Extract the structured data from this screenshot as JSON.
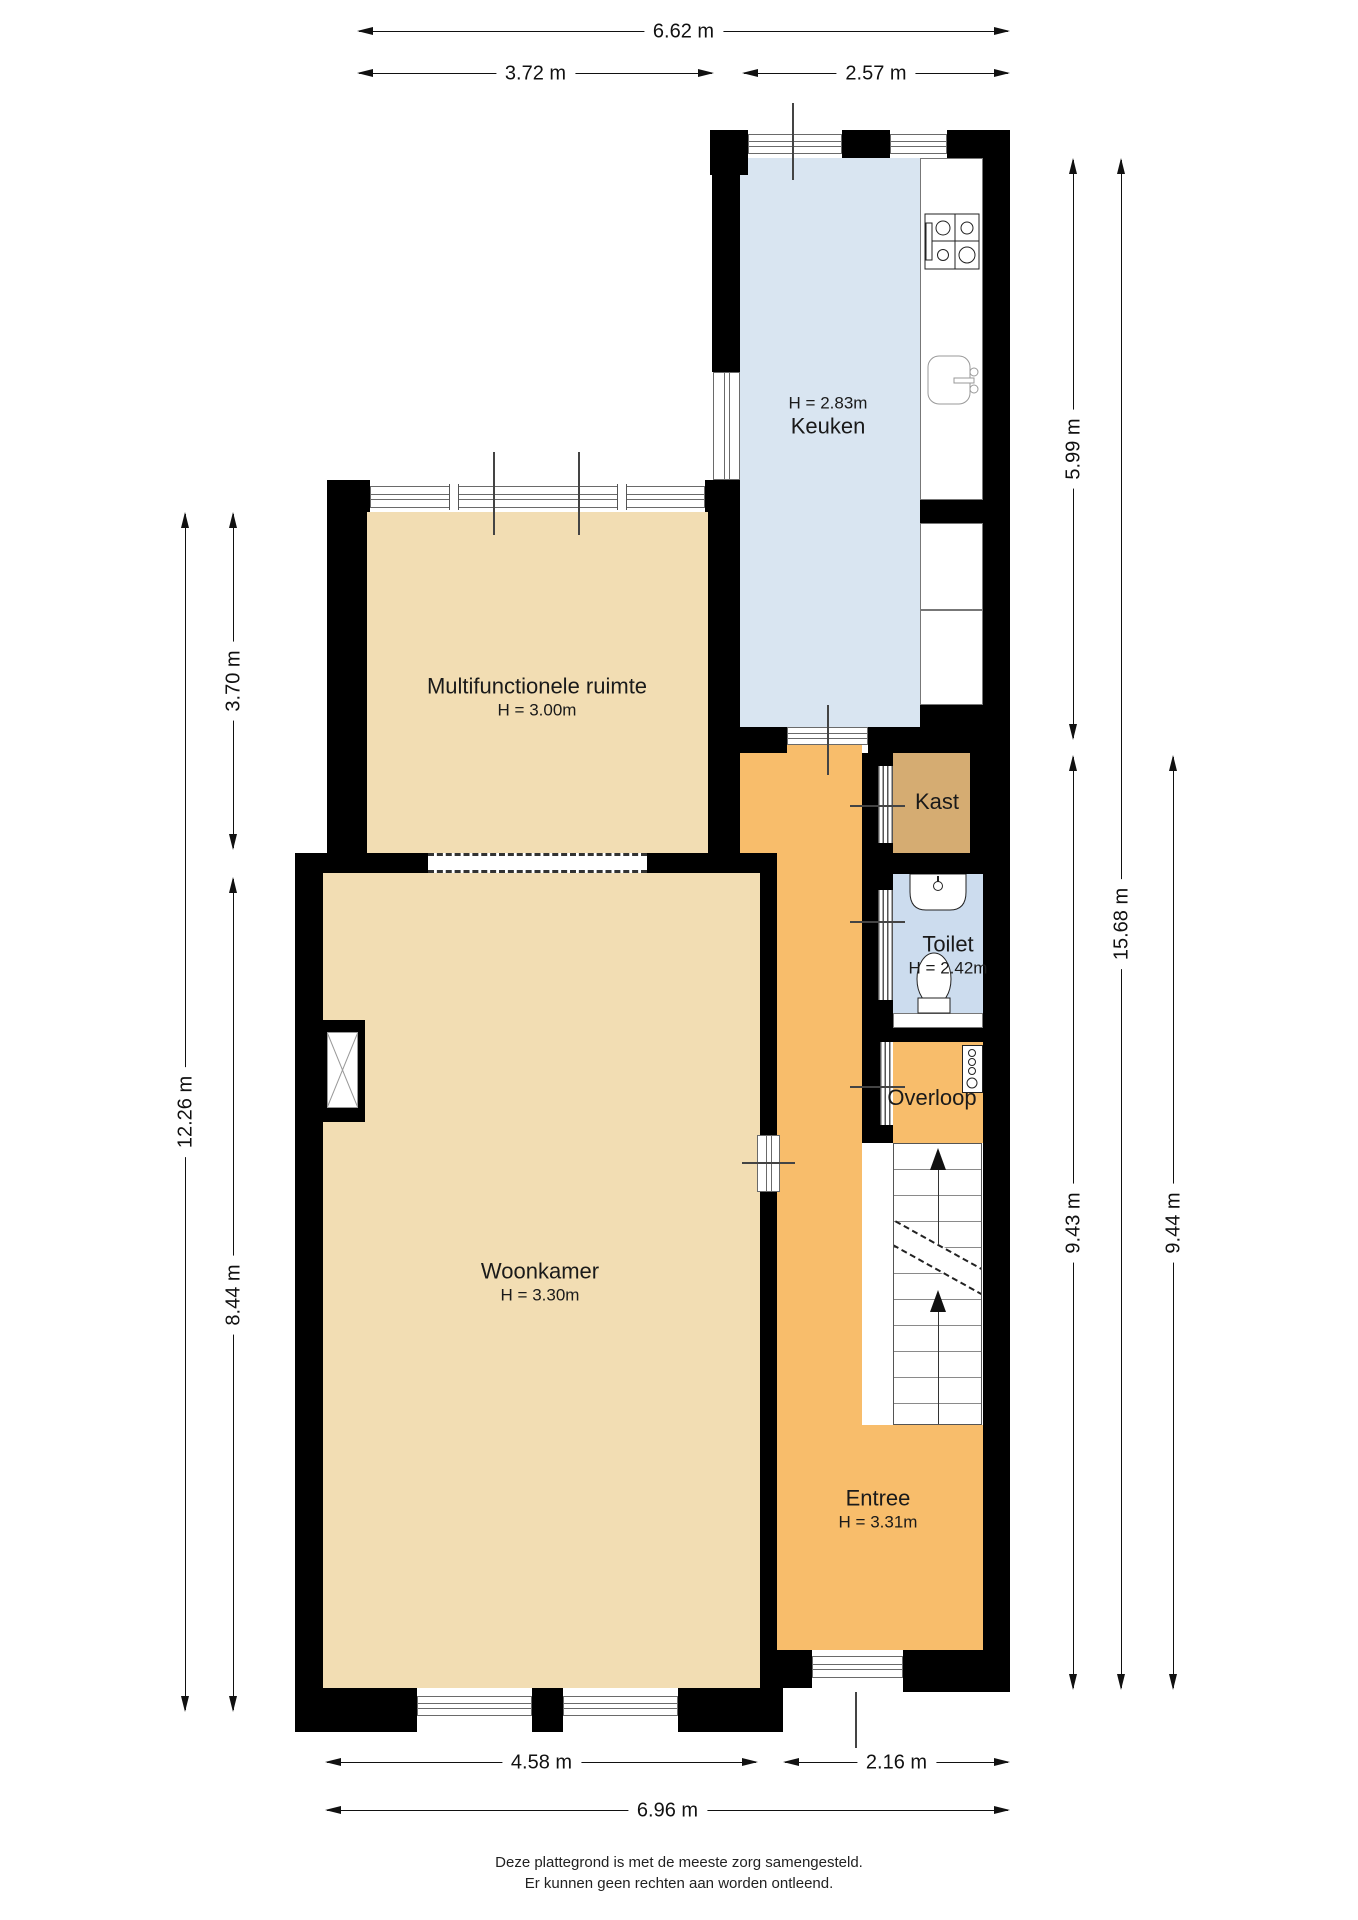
{
  "rooms": {
    "keuken": {
      "name": "Keuken",
      "height": "H = 2.83m"
    },
    "multifunctionele_ruimte": {
      "name": "Multifunctionele ruimte",
      "height": "H = 3.00m"
    },
    "woonkamer": {
      "name": "Woonkamer",
      "height": "H = 3.30m"
    },
    "entree": {
      "name": "Entree",
      "height": "H = 3.31m"
    },
    "kast": {
      "name": "Kast"
    },
    "toilet": {
      "name": "Toilet",
      "height": "H = 2.42m"
    },
    "overloop": {
      "name": "Overloop"
    }
  },
  "dimensions": {
    "top": {
      "total": "6.62 m",
      "left": "3.72 m",
      "right": "2.57 m"
    },
    "left": {
      "total": "12.26 m",
      "upper": "3.70 m",
      "lower": "8.44 m"
    },
    "right": {
      "kitchen": "5.99 m",
      "total": "15.68 m",
      "hall_inner": "9.43 m",
      "hall_outer": "9.44 m"
    },
    "bottom": {
      "living": "4.58 m",
      "hall": "2.16 m",
      "total": "6.96 m"
    }
  },
  "footer": {
    "line1": "Deze plattegrond is met de meeste zorg samengesteld.",
    "line2": "Er kunnen geen rechten aan worden ontleend."
  },
  "colors": {
    "wall": "#000000",
    "kitchen_floor": "#d9e5f1",
    "toilet_floor": "#ccdcee",
    "living_floor": "#f2ddb3",
    "hall_floor": "#f8bd6b",
    "closet_floor": "#d5ac72"
  }
}
